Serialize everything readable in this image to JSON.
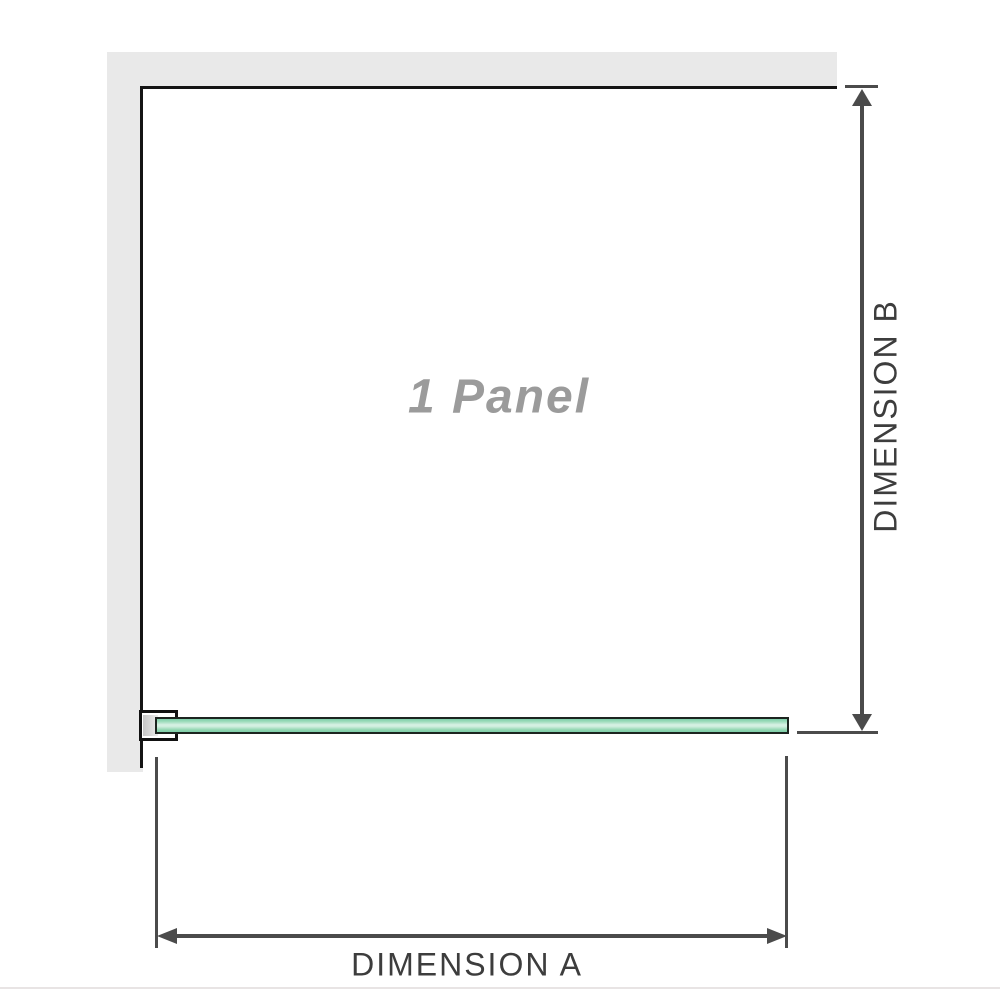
{
  "diagram": {
    "title": "Single glass panel dimension diagram",
    "panel_label": "1 Panel",
    "dimension_a_label": "DIMENSION A",
    "dimension_b_label": "DIMENSION B",
    "parts": {
      "wall": "L-shaped wall (top and left)",
      "glass_bar": "glass panel top view",
      "bracket": "wall mounting bracket"
    },
    "colors": {
      "wall_fill": "#e9e9e9",
      "outline_black": "#141414",
      "dimension_gray": "#4b4b4b",
      "dimension_label_gray": "#3d3d3d",
      "panel_label_gray": "#9b9b9b",
      "glass_border": "#1c241f",
      "glass_green": "#8fd5af",
      "glass_green_pale": "#d8f1e4",
      "bottom_divider": "#e8e4e4"
    }
  }
}
